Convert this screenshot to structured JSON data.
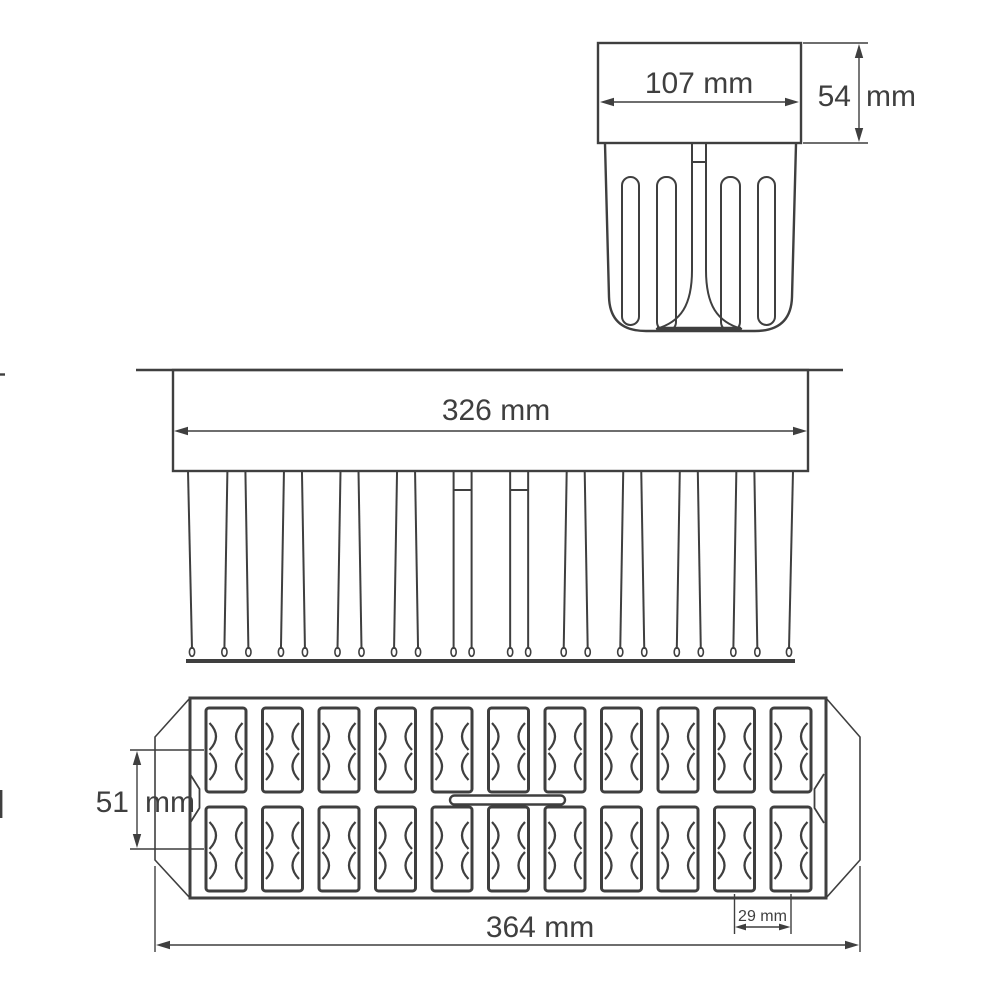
{
  "drawing": {
    "colors": {
      "line": "#3f3f3f",
      "background": "#ffffff"
    },
    "side_view": {
      "width_label": "107 mm",
      "height_value": "54",
      "height_unit": "mm"
    },
    "front_view": {
      "width_label": "326 mm",
      "cavity_count": 11
    },
    "top_view": {
      "grid_columns": 11,
      "grid_rows": 2,
      "row_pitch_value": "51",
      "row_pitch_unit": "mm",
      "cavity_pitch_label": "29 mm",
      "overall_width_label": "364 mm"
    }
  }
}
